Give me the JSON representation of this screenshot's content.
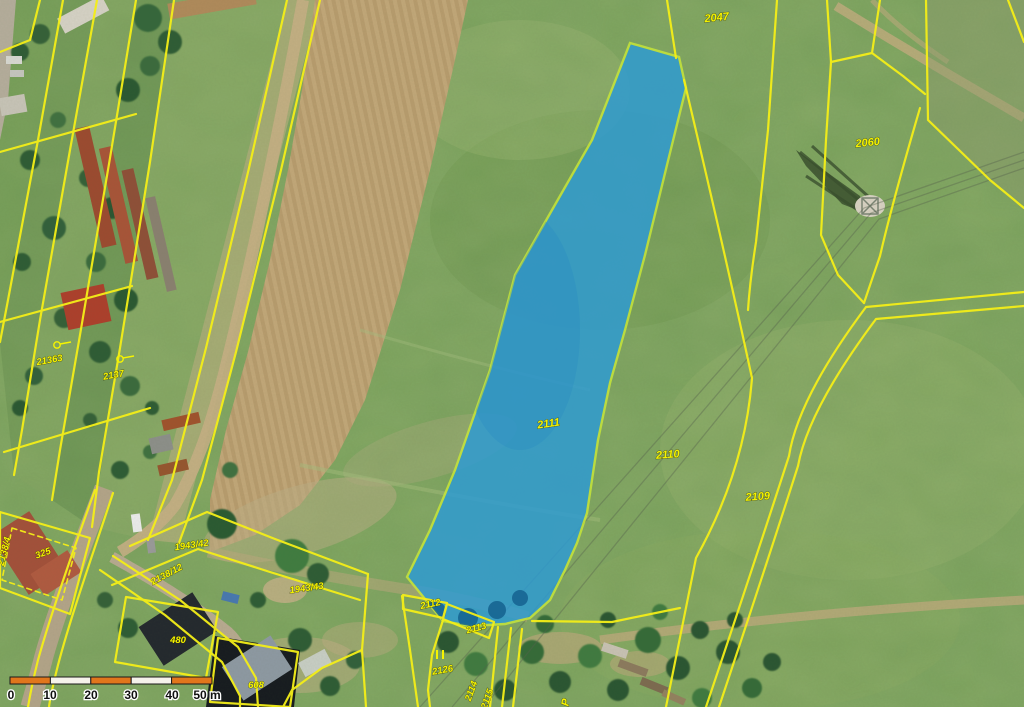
{
  "map": {
    "kind": "cadastral aerial map",
    "highlight_fill": "#2c9bd6",
    "boundary_color": "#f4ee18",
    "label_color": "#f6f400"
  },
  "parcels": {
    "l2047": "2047",
    "l2060": "2060",
    "l2111": "2111",
    "l2110": "2110",
    "l2109": "2109",
    "l21363": "21363",
    "l2137": "2137",
    "l1943_42": "1943/42",
    "l1943_43": "1943/43",
    "l2138_12": "2138/12",
    "l2138_4": "2138/4",
    "l325": "325",
    "l480": "480",
    "l608": "608",
    "l2112": "2112",
    "l2113": "2113",
    "l2126": "2126",
    "l2114": "2114",
    "l2115": "2115",
    "lP": "P"
  },
  "scale_bar": {
    "ticks": [
      "0",
      "10",
      "20",
      "30",
      "40",
      "50 m"
    ]
  }
}
